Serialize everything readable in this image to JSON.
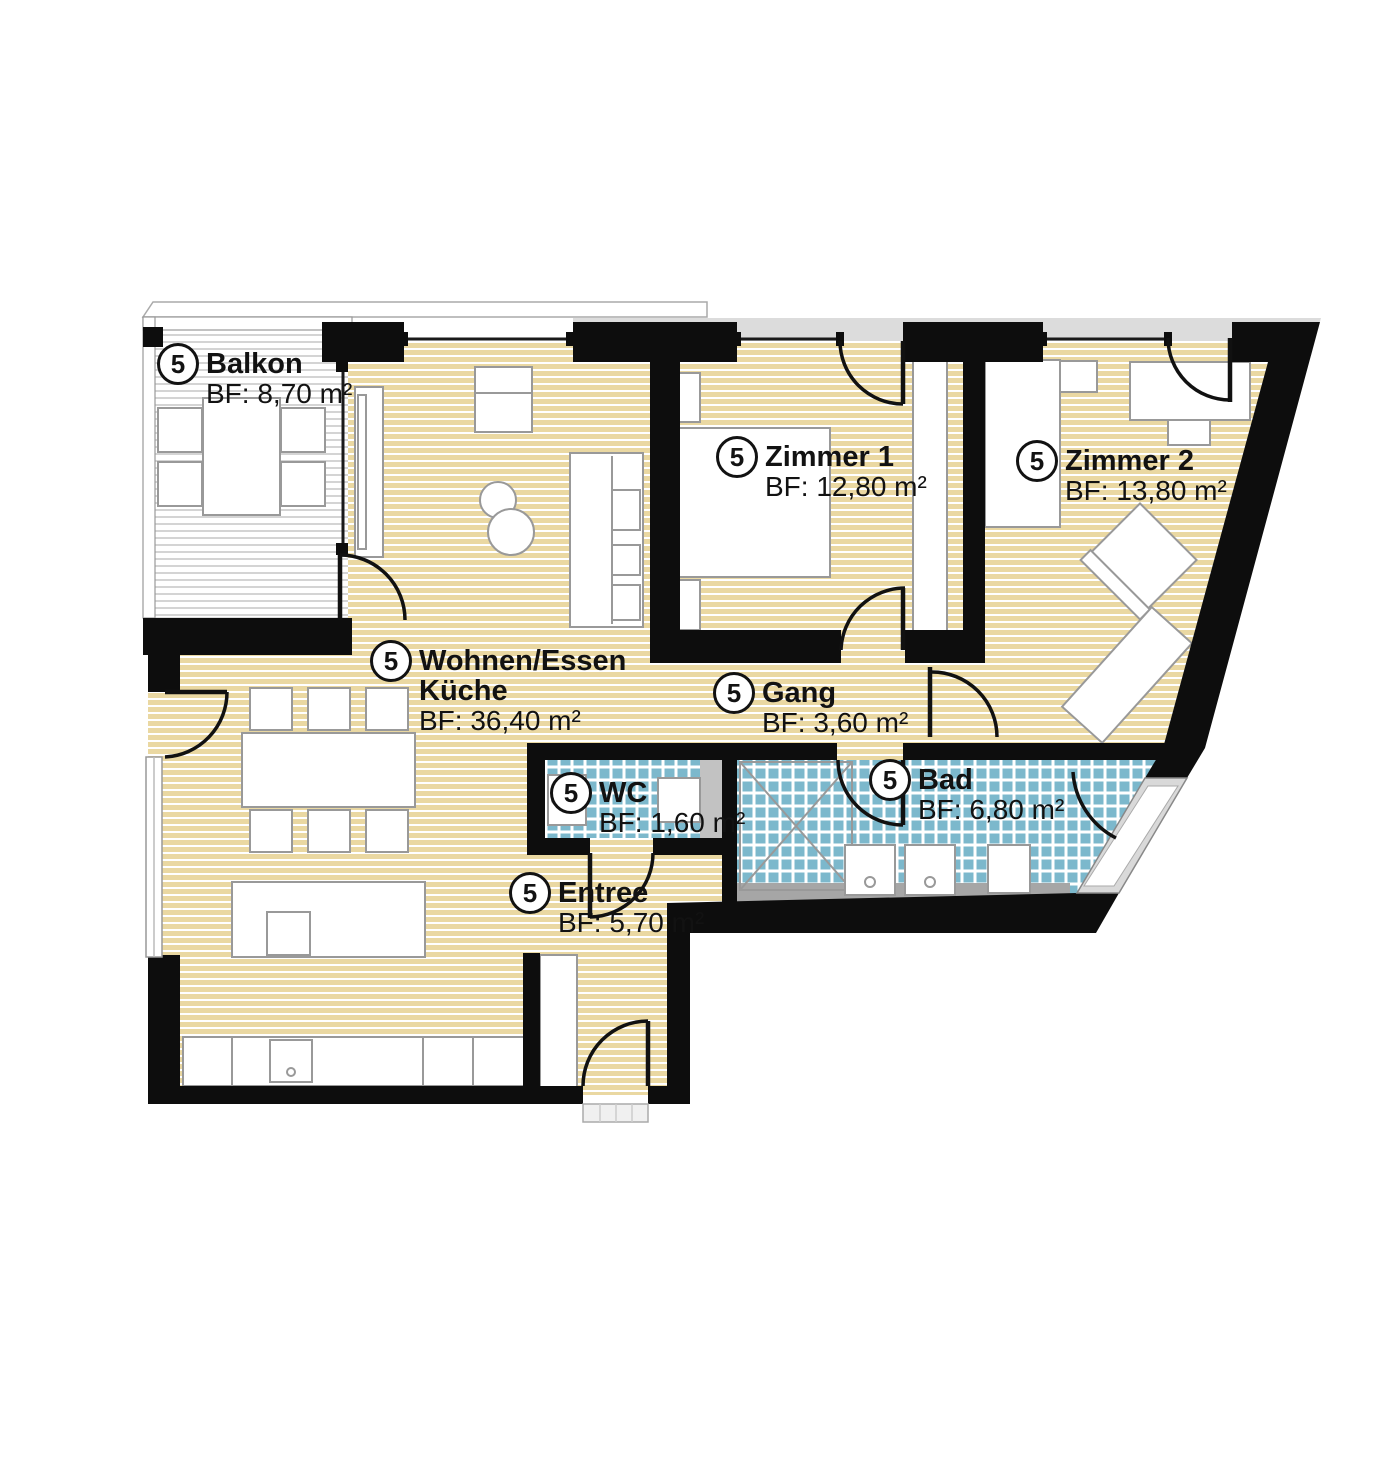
{
  "plan": {
    "unit_number": "5",
    "rooms": [
      {
        "id": "balkon",
        "number": "5",
        "name": "Balkon",
        "name2": "",
        "area": "BF: 8,70 m²"
      },
      {
        "id": "wohnen",
        "number": "5",
        "name": "Wohnen/Essen",
        "name2": "Küche",
        "area": "BF: 36,40 m²"
      },
      {
        "id": "zimmer1",
        "number": "5",
        "name": "Zimmer 1",
        "name2": "",
        "area": "BF: 12,80 m²"
      },
      {
        "id": "zimmer2",
        "number": "5",
        "name": "Zimmer 2",
        "name2": "",
        "area": "BF: 13,80 m²"
      },
      {
        "id": "gang",
        "number": "5",
        "name": "Gang",
        "name2": "",
        "area": "BF: 3,60 m²"
      },
      {
        "id": "wc",
        "number": "5",
        "name": "WC",
        "name2": "",
        "area": "BF: 1,60 m²"
      },
      {
        "id": "bad",
        "number": "5",
        "name": "Bad",
        "name2": "",
        "area": "BF: 6,80 m²"
      },
      {
        "id": "entree",
        "number": "5",
        "name": "Entree",
        "name2": "",
        "area": "BF: 5,70 m²"
      }
    ],
    "colors": {
      "wall": "#0d0d0d",
      "parquet": "#ead8a2",
      "tile": "#7cb8cc",
      "deck_stripe": "#d4d4d4",
      "terrace_gray": "#dcdcdc",
      "fixture_stroke": "#999999",
      "vanity_gray": "#a6a6a6"
    }
  }
}
